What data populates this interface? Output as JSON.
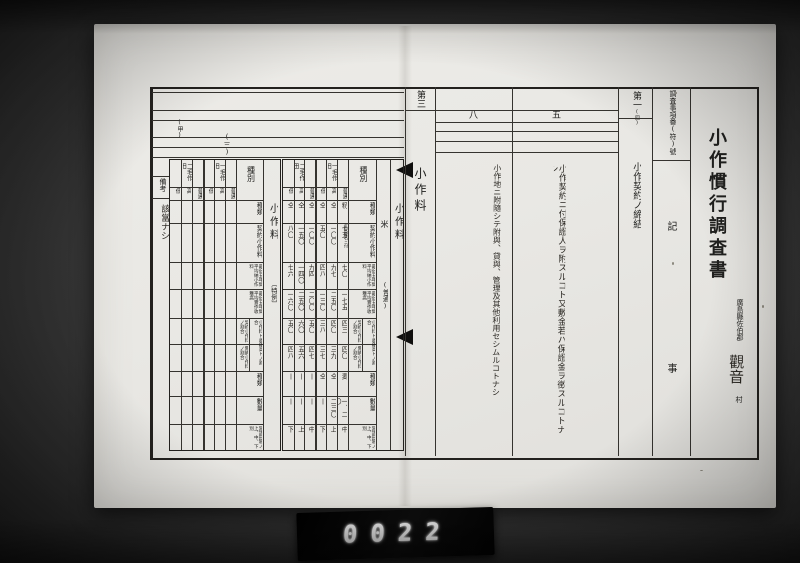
{
  "photo": {
    "counter": "0022"
  },
  "doc": {
    "title": "小作慣行調査書",
    "issuer": "廣島縣佐伯郡",
    "village": "觀音",
    "village_suffix": "村",
    "header_col": {
      "label": "調査事項番(符)號",
      "body_top": "記",
      "body_bottom": "事"
    },
    "items": [
      {
        "no": "第一",
        "no_sub": "(四)",
        "text": "小作契約ノ締結"
      },
      {
        "no": "五",
        "text": "小作契約ニ付保證人ヲ附スルコト又敷金若ハ保證金ヲ徴スルコトナシ"
      },
      {
        "no": "八",
        "text": "小作地ニ附隨シテ附與、貸與、管理及其他利用セシムルコトナシ"
      },
      {
        "no": "第三",
        "text": "小作料"
      }
    ],
    "left_page": {
      "mark_1": "(甲)",
      "mark_2": "(三)",
      "remarks_label": "備考",
      "remarks_value": "該當ナシ"
    }
  },
  "main_table": {
    "section": "小作料",
    "crop": "米",
    "crop_note": "(普通)",
    "kind_header": "種別",
    "groups": [
      "二毛作田",
      "一毛作田"
    ],
    "subcols": [
      "低",
      "高",
      "普通",
      "低",
      "高",
      "普通"
    ],
    "ratio_group_label": "小作料ト收穫高トノ割合",
    "rows": [
      {
        "label": "種類",
        "values": [
          "仝",
          "仝",
          "仝",
          "仝",
          "仝",
          "籾"
        ]
      },
      {
        "label": "契約小作料",
        "values": [
          "八〇",
          "一五〇",
          "一〇〇",
          "五〇",
          "一〇〇",
          "七五"
        ],
        "note": "玄米壹石ニ付"
      },
      {
        "label": "最近五年間平均納小作料",
        "values": [
          "七六",
          "一四〇",
          "九四",
          "四八",
          "九七",
          "七〇"
        ]
      },
      {
        "label": "最近五年間平均實作收穫高",
        "values": [
          "一六〇",
          "二五〇",
          "二〇〇",
          "一三〇",
          "二五〇",
          "一七五"
        ]
      },
      {
        "label": "契約小作料ノ割合",
        "values": [
          "五〇",
          "六〇",
          "五〇",
          "三八",
          "四〇",
          "四三"
        ]
      },
      {
        "label": "實納小作料ノ割合",
        "values": [
          "四八",
          "五六",
          "四七",
          "三七",
          "三九",
          "四〇"
        ]
      },
      {
        "label": "種類",
        "values": [
          "丨",
          "丨",
          "丨",
          "仝",
          "仝",
          "麦"
        ]
      },
      {
        "label": "數量",
        "values": [
          "丨",
          "丨",
          "丨",
          "丨",
          "二三〇",
          "一、二〇"
        ]
      },
      {
        "label": "當該田地ノ上、中、下別",
        "values": [
          "下",
          "上",
          "中",
          "下",
          "上",
          "中"
        ]
      }
    ]
  },
  "special_table": {
    "section": "小作料",
    "crop_note": "〔特例〕",
    "kind_header": "種別",
    "groups": [
      "二毛作田",
      "一毛作田"
    ],
    "subcols": [
      "低",
      "高",
      "普通",
      "低",
      "高",
      "普通"
    ],
    "ratio_group_label": "小作料ト收穫高トノ割合",
    "rows": [
      {
        "label": "種類",
        "values": [
          "",
          "",
          "",
          "",
          "",
          ""
        ]
      },
      {
        "label": "契約小作料",
        "values": [
          "",
          "",
          "",
          "",
          "",
          ""
        ]
      },
      {
        "label": "最近五年間平均納小作料",
        "values": [
          "",
          "",
          "",
          "",
          "",
          ""
        ]
      },
      {
        "label": "最近五年間平均實作收穫高",
        "values": [
          "",
          "",
          "",
          "",
          "",
          ""
        ]
      },
      {
        "label": "契約小作料ノ割合",
        "values": [
          "",
          "",
          "",
          "",
          "",
          ""
        ]
      },
      {
        "label": "實納小作料ノ割合",
        "values": [
          "",
          "",
          "",
          "",
          "",
          ""
        ]
      },
      {
        "label": "種類",
        "values": [
          "",
          "",
          "",
          "",
          "",
          ""
        ]
      },
      {
        "label": "數量",
        "values": [
          "",
          "",
          "",
          "",
          "",
          ""
        ]
      },
      {
        "label": "當該田地ノ上、中、下別",
        "values": [
          "",
          "",
          "",
          "",
          "",
          ""
        ]
      }
    ]
  }
}
